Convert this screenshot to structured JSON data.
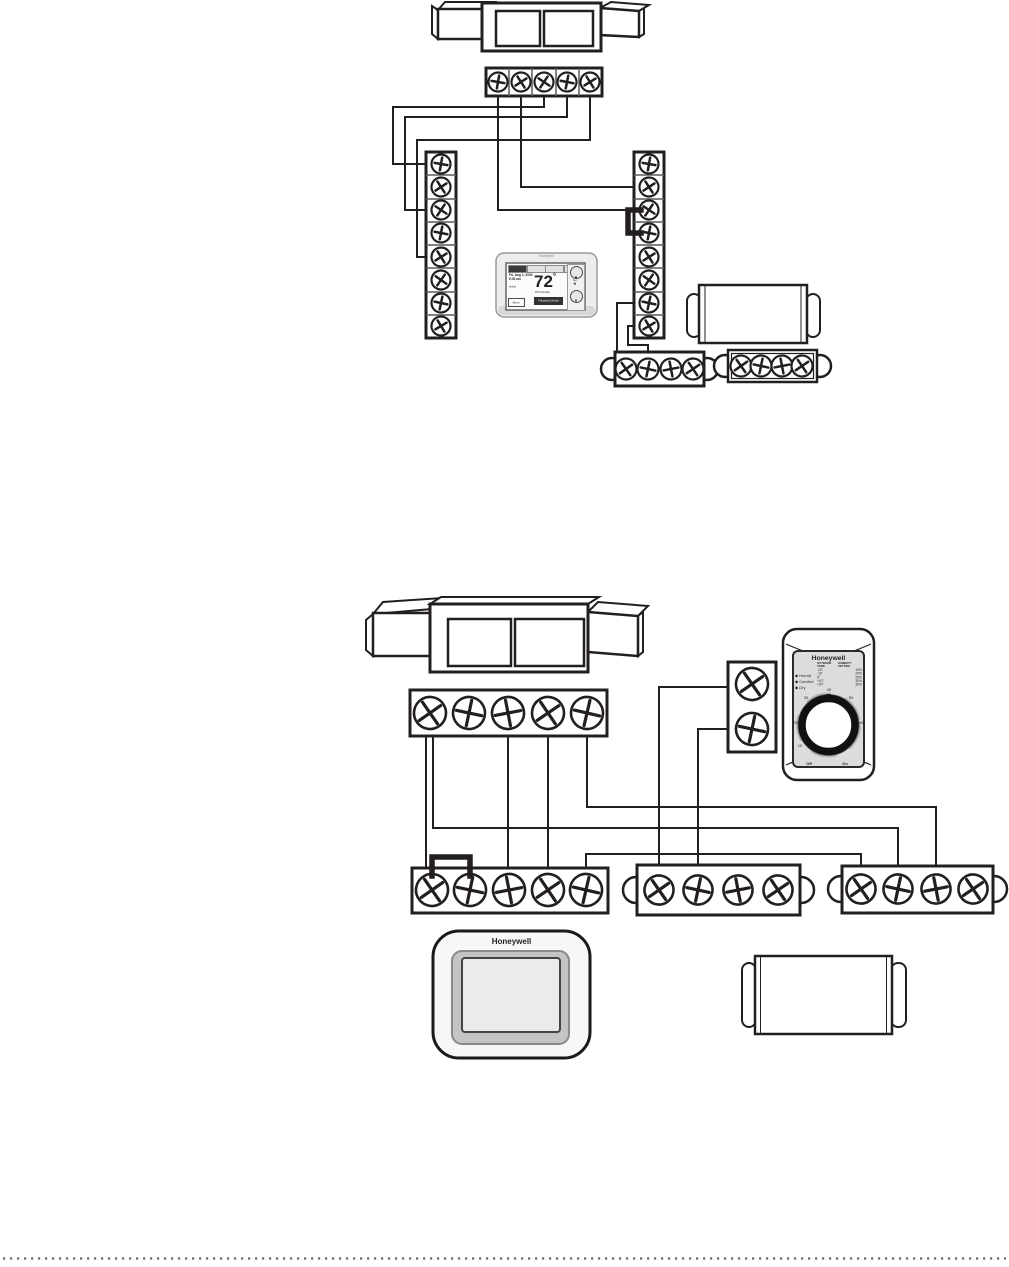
{
  "diagram_top": {
    "thermostat": {
      "brand": "Honeywell",
      "screen": {
        "date_line": "Fri, Aug 1, 2003",
        "time_line": "6:30 am",
        "inside_label": "Inside",
        "temp_value": "72",
        "temp_unit": "°",
        "humidity_line": "45% Humidity",
        "status_line": "Following Schedule",
        "more_label": "More",
        "set_to_label": "Set To",
        "set_to_value": "72",
        "up_glyph": "▲",
        "down_glyph": "▼"
      }
    }
  },
  "diagram_bottom": {
    "humidistat": {
      "brand": "Honeywell",
      "indicators": [
        {
          "bullet": "◆",
          "label": "Humid"
        },
        {
          "bullet": "◆",
          "label": "Comfort"
        },
        {
          "bullet": "◆",
          "label": "Dry"
        }
      ],
      "table": {
        "col1_header": "OUTDOOR TEMP.",
        "col2_header": "HUMIDITY SETTING",
        "rows": [
          [
            "-20°",
            "15%"
          ],
          [
            "-10°",
            "20%"
          ],
          [
            "0°",
            "25%"
          ],
          [
            "+10°",
            "30%"
          ],
          [
            "+20°",
            "35%"
          ]
        ]
      },
      "dial": {
        "n10": "10",
        "n20": "20",
        "n30": "30",
        "n40": "40",
        "n50": "50",
        "n60": "60",
        "off_label": "Off",
        "on_label": "On"
      }
    },
    "thermostat": {
      "brand": "Honeywell"
    }
  }
}
